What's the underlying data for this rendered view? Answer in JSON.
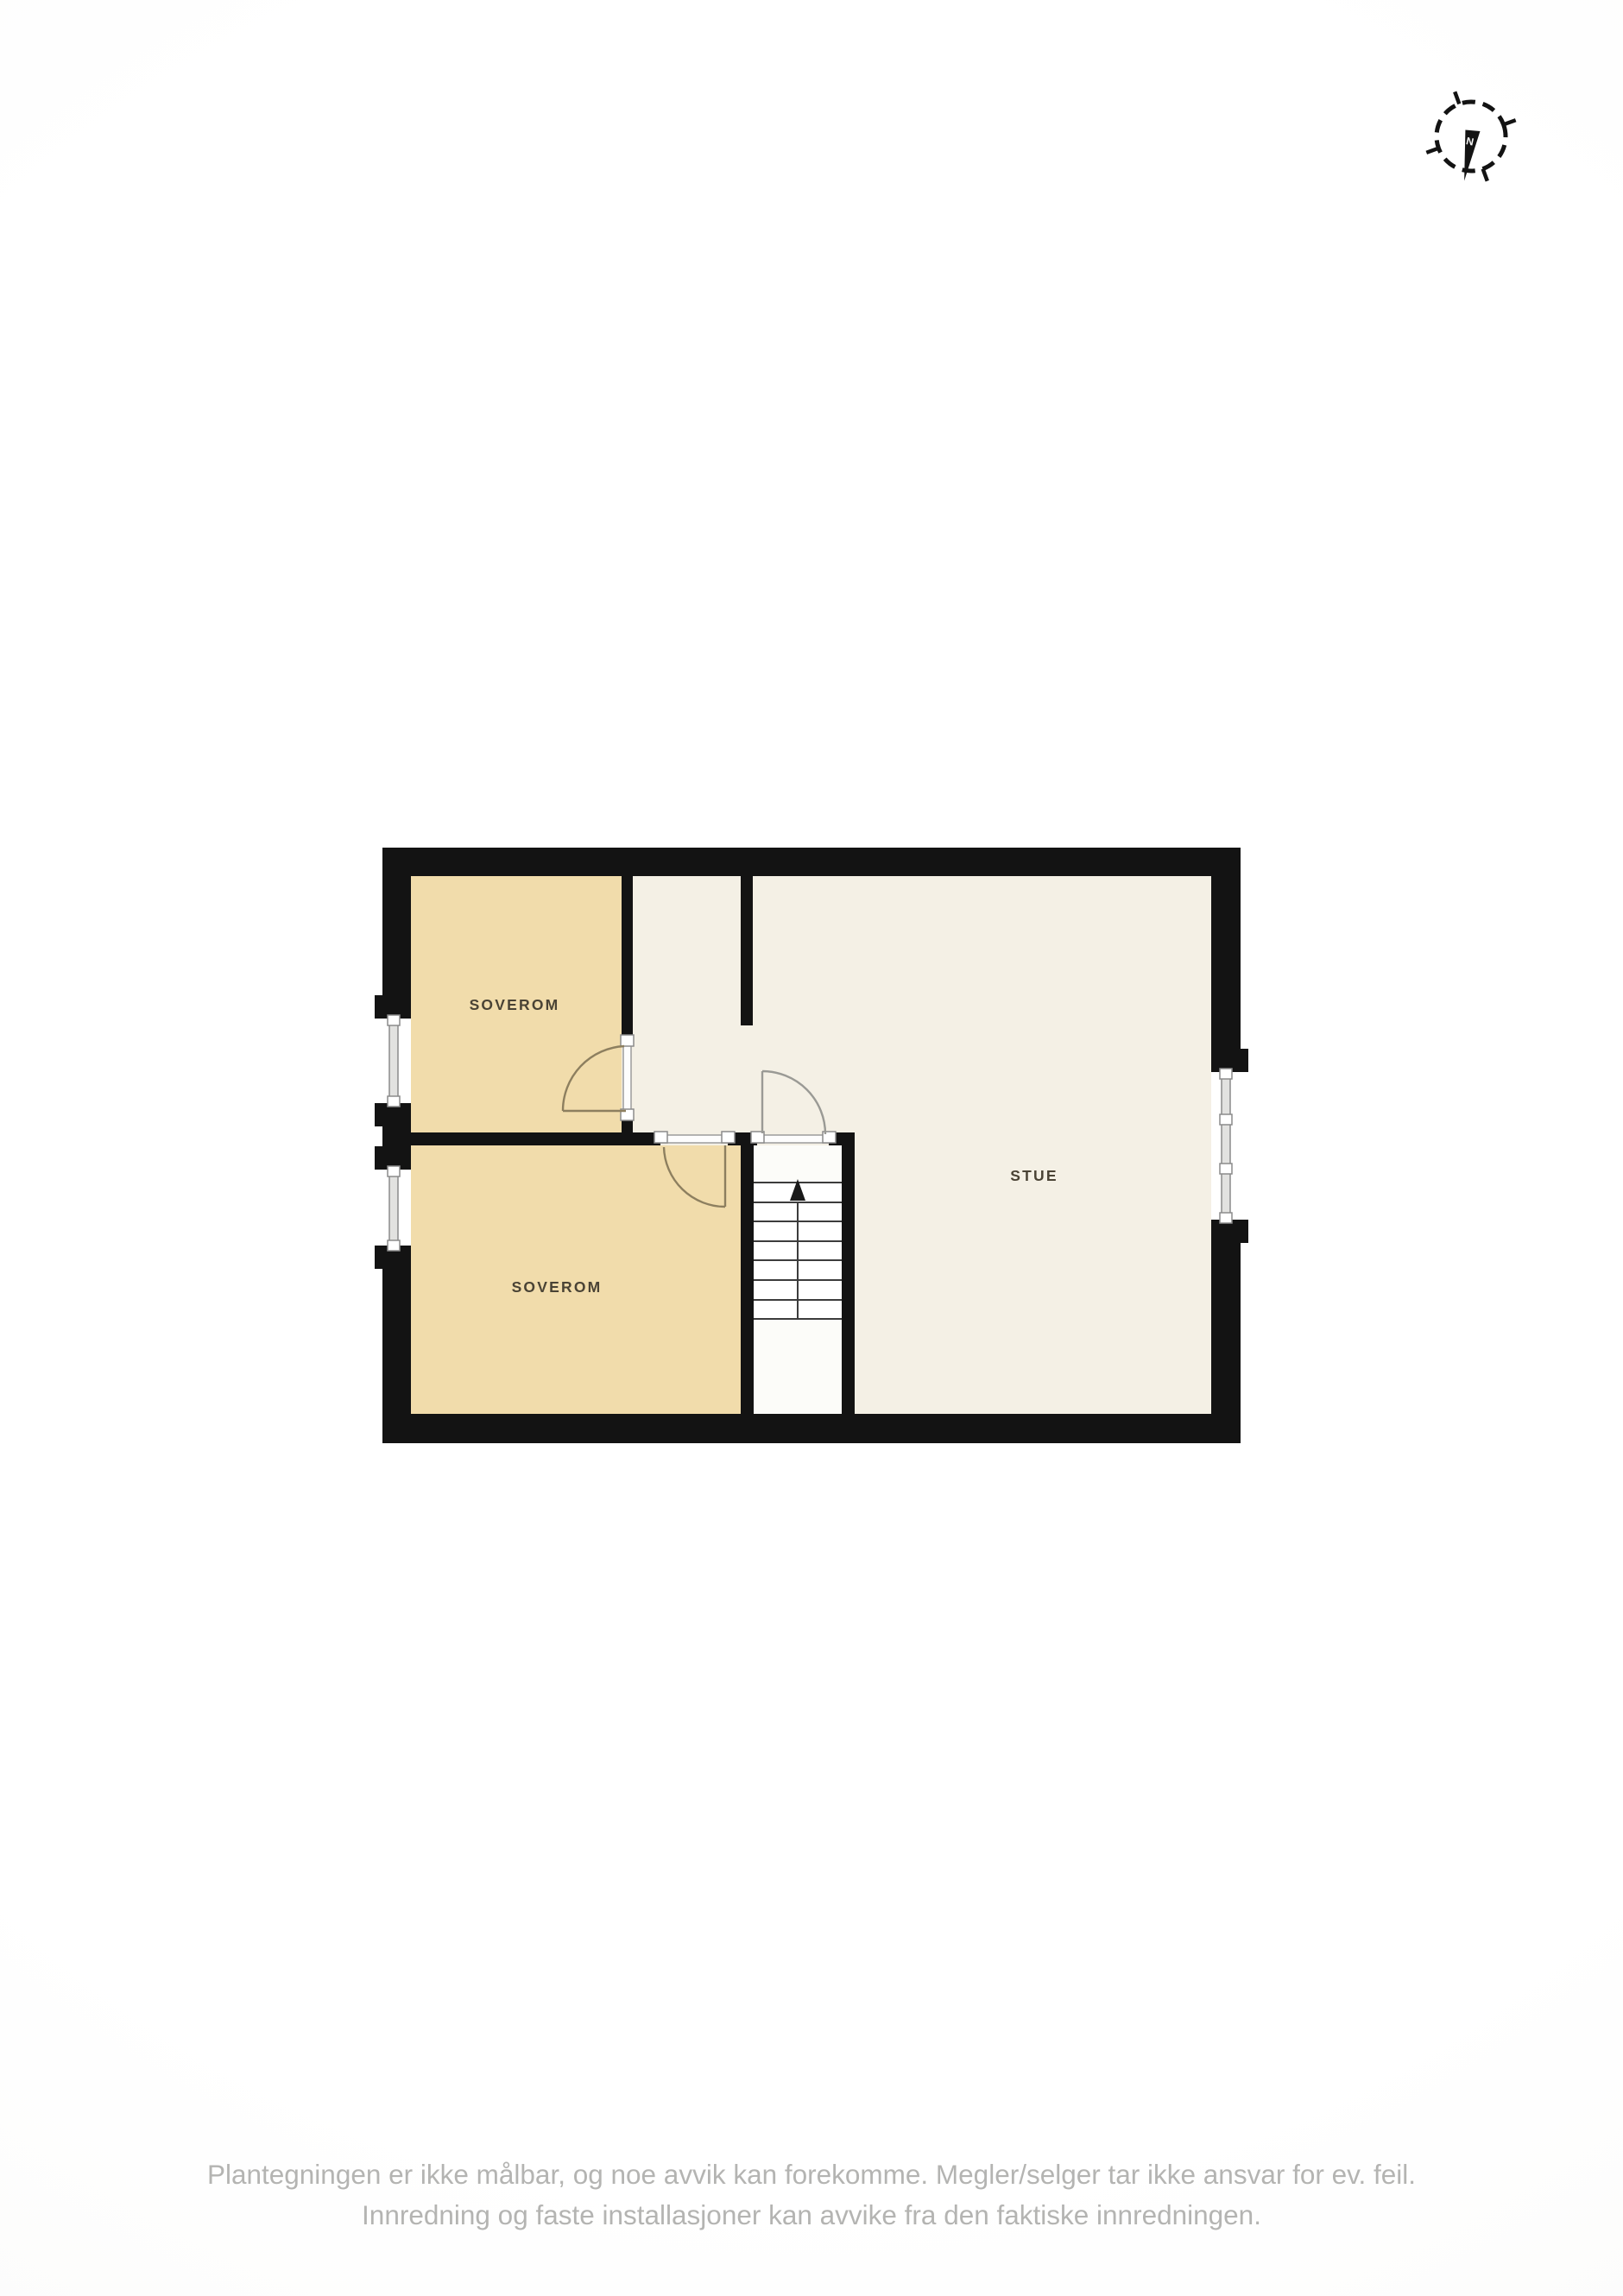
{
  "floorplan": {
    "rooms": {
      "soverom1": {
        "label": "SOVEROM",
        "fill": "#f1dcab"
      },
      "soverom2": {
        "label": "SOVEROM",
        "fill": "#f1dcab"
      },
      "stue": {
        "label": "STUE",
        "fill": "#f4f0e5"
      }
    },
    "stairs": {
      "tread_count": 8,
      "direction": "up"
    },
    "compass": {
      "north_label": "N"
    },
    "colors": {
      "wall": "#131313",
      "bedroom_fill": "#f1dcab",
      "living_fill": "#f4f0e5",
      "stairwell_fill": "#fcfcf9",
      "door_arc": "#8d7f5f",
      "stair_door_arc": "#9a9a95",
      "window_glass": "#e2e2e0",
      "opening_outline": "#8b8b8b",
      "room_label_text": "#4a4335",
      "disclaimer_text": "#b4b4b2"
    }
  },
  "disclaimer": {
    "line1": "Plantegningen er ikke målbar, og noe avvik kan forekomme. Megler/selger tar ikke ansvar for ev. feil.",
    "line2": "Innredning og faste installasjoner kan avvike fra den faktiske innredningen."
  }
}
